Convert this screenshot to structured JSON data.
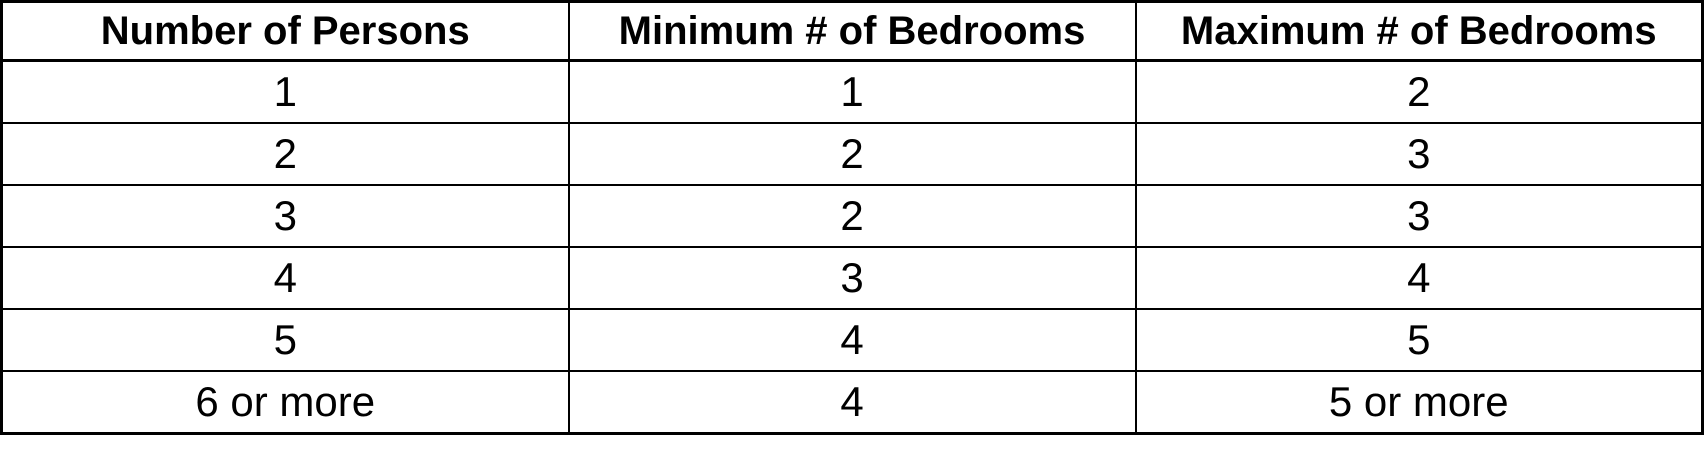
{
  "table": {
    "headers": [
      "Number of Persons",
      "Minimum # of Bedrooms",
      "Maximum # of Bedrooms"
    ],
    "rows": [
      [
        "1",
        "1",
        "2"
      ],
      [
        "2",
        "2",
        "3"
      ],
      [
        "3",
        "2",
        "3"
      ],
      [
        "4",
        "3",
        "4"
      ],
      [
        "5",
        "4",
        "5"
      ],
      [
        "6 or more",
        "4",
        "5 or more"
      ]
    ]
  },
  "chart_data": {
    "type": "table",
    "columns": [
      "Number of Persons",
      "Minimum # of Bedrooms",
      "Maximum # of Bedrooms"
    ],
    "rows": [
      [
        "1",
        "1",
        "2"
      ],
      [
        "2",
        "2",
        "3"
      ],
      [
        "3",
        "2",
        "3"
      ],
      [
        "4",
        "3",
        "4"
      ],
      [
        "5",
        "4",
        "5"
      ],
      [
        "6 or more",
        "4",
        "5 or more"
      ]
    ]
  },
  "colors": {
    "border": "#000000",
    "text": "#000000",
    "background": "#ffffff"
  }
}
